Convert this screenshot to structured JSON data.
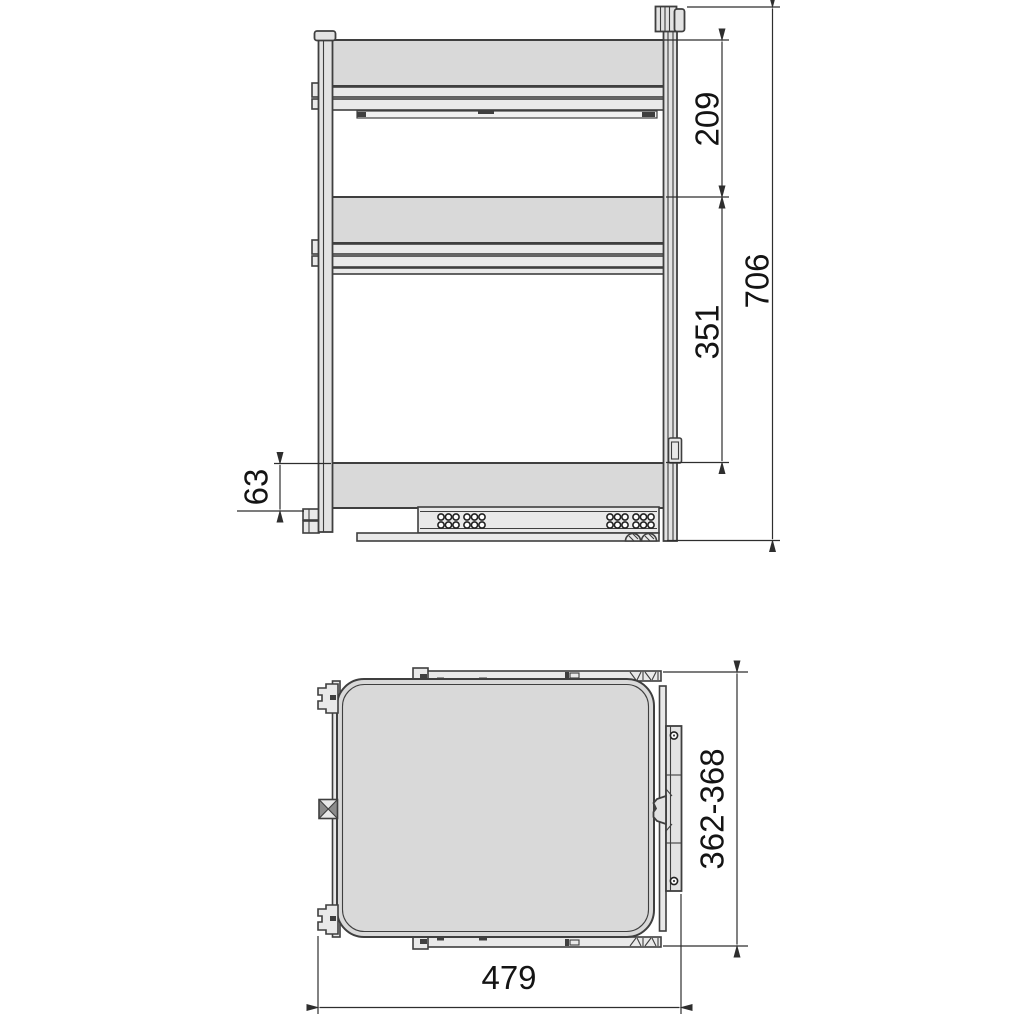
{
  "front_view": {
    "dims": {
      "upper_shelf_spacing": "209",
      "lower_shelf_spacing": "351",
      "overall_height": "706",
      "base_height": "63"
    }
  },
  "plan_view": {
    "dims": {
      "depth_range": "362-368",
      "overall_width": "479"
    }
  },
  "colors": {
    "line": "#3f3f3f",
    "dimension_line": "#2e2e2e",
    "panel_fill": "#d9d9d9",
    "profile_fill": "#e9e9e9",
    "text": "#141414",
    "background": "#ffffff"
  }
}
